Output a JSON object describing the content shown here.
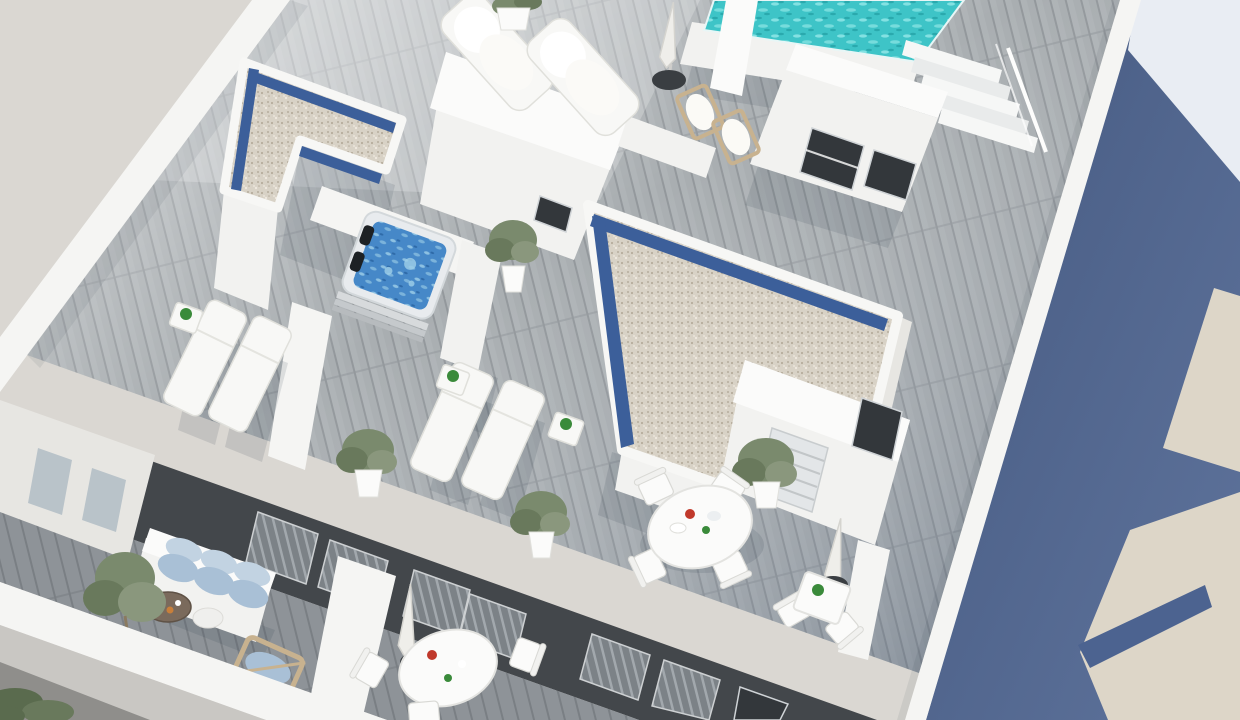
{
  "meta": {
    "kind": "3d-architectural-rendering",
    "subject": "aerial-view-of-rooftop-terraces-with-pool-jacuzzi-and-balconies",
    "visible_text": ""
  },
  "palette": {
    "bg": "#dad7d2",
    "shadowPlane": "#4c6390",
    "adjacentLight": "#e9edf3",
    "adjacentBeige": "#ddd6c8",
    "parapet": "#f5f5f3",
    "wallWhite": "#f2f2f0",
    "wallLite": "#fbfbfa",
    "wallShade": "#e7e6e2",
    "facadeDark": "#43474b",
    "deckA": "#a9aeb1",
    "deckSeam": "#93989c",
    "deckDarkA": "#8e9398",
    "deckDarkSeam": "#7a7f84",
    "gravelA": "#d8d2c6",
    "gravelB": "#b6ad9d",
    "gravelC": "#efe9df",
    "solarBlue": "#3c5f9a",
    "poolA": "#3ec4c7",
    "poolB": "#8fe7e6",
    "spaA": "#4688c8",
    "spaB": "#9fd0e8",
    "plantA": "#7a8a6d",
    "plantB": "#69795c",
    "plantC": "#8a977d",
    "vegDark": "#5a6b4e",
    "cushionA": "#a9c0d6",
    "cushionB": "#c2d3e2",
    "woodTan": "#c8b28f",
    "tableWood": "#7a6a5c",
    "accentRed": "#c0392b",
    "accentGreen": "#3a8a3a",
    "umbrellaBase": "#3a3e42",
    "windowGlass": "#b9c3c9"
  },
  "scene": {
    "regions": [
      {
        "label": "rooftop-terraces"
      },
      {
        "label": "swimming-pool-with-stairs"
      },
      {
        "label": "jacuzzi-courtyard"
      },
      {
        "label": "gravel-roof-volumes-with-solar-strips"
      },
      {
        "label": "lower-floor-balconies"
      },
      {
        "label": "street-shadow-plane-with-adjacent-buildings"
      }
    ],
    "objects": [
      {
        "label": "swimming-pool"
      },
      {
        "label": "pool-stairs"
      },
      {
        "label": "stair-bulkhead"
      },
      {
        "label": "jacuzzi"
      },
      {
        "label": "sun-loungers"
      },
      {
        "label": "plush-loungers"
      },
      {
        "label": "wooden-deck-chairs"
      },
      {
        "label": "closed-parasols"
      },
      {
        "label": "round-dining-table-set"
      },
      {
        "label": "bistro-table-set"
      },
      {
        "label": "balcony-sofa-set"
      },
      {
        "label": "balcony-round-table-set"
      },
      {
        "label": "potted-plants"
      },
      {
        "label": "planter-shrubs"
      }
    ]
  }
}
